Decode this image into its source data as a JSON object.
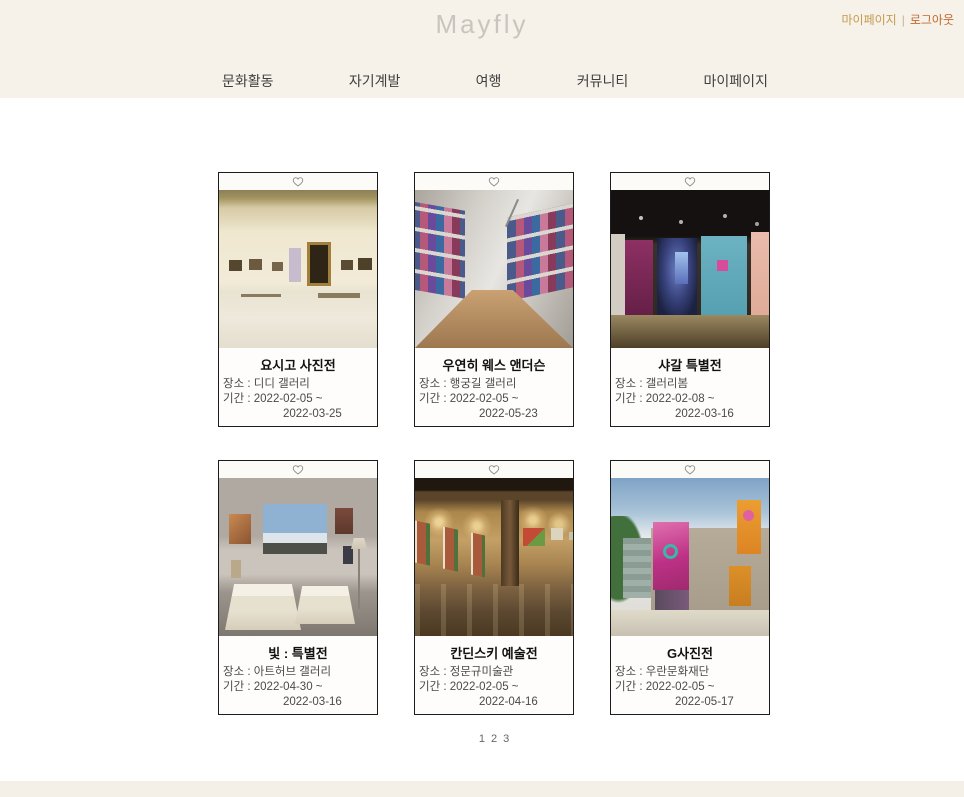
{
  "header": {
    "logo": "Mayfly",
    "links": {
      "mypage": "마이페이지",
      "separator": "|",
      "logout": "로그아웃"
    }
  },
  "nav": {
    "items": [
      {
        "label": "문화활동"
      },
      {
        "label": "자기계발"
      },
      {
        "label": "여행"
      },
      {
        "label": "커뮤니티"
      },
      {
        "label": "마이페이지"
      }
    ]
  },
  "exhibitions": [
    {
      "title": "요시고 사진전",
      "venue_label": "장소 :",
      "venue": "디디 갤러리",
      "period_label": "기간 :",
      "period_start": "2022-02-05 ~",
      "period_end": "2022-03-25",
      "image": "cream-gallery-framed-art"
    },
    {
      "title": "우연히 웨스 앤더슨",
      "venue_label": "장소 :",
      "venue": "행궁길 갤러리",
      "period_label": "기간 :",
      "period_start": "2022-02-05 ~",
      "period_end": "2022-05-23",
      "image": "white-gallery-colorful-photo-grid"
    },
    {
      "title": "샤갈 특별전",
      "venue_label": "장소 :",
      "venue": "갤러리봄",
      "period_label": "기간 :",
      "period_start": "2022-02-08 ~",
      "period_end": "2022-03-16",
      "image": "dark-gallery-magenta-blue-walls"
    },
    {
      "title": "빛 : 특별전",
      "venue_label": "장소 :",
      "venue": "아트허브 갤러리",
      "period_label": "기간 :",
      "period_start": "2022-04-30 ~",
      "period_end": "2022-03-16",
      "image": "exhibit-room-paris-photos-draped-tables"
    },
    {
      "title": "칸딘스키 예술전",
      "venue_label": "장소 :",
      "venue": "정문규미술관",
      "period_label": "기간 :",
      "period_start": "2022-02-05 ~",
      "period_end": "2022-04-16",
      "image": "warm-gallery-spotlit-paintings"
    },
    {
      "title": "G사진전",
      "venue_label": "장소 :",
      "venue": "우란문화재단",
      "period_label": "기간 :",
      "period_start": "2022-02-05 ~",
      "period_end": "2022-05-17",
      "image": "museum-exterior-pink-orange-banners"
    }
  ],
  "pagination": {
    "pages": [
      "1",
      "2",
      "3"
    ]
  },
  "icons": {
    "favorite": "heart-outline"
  },
  "colors": {
    "header_bg": "#f6f2ea",
    "mypage_link": "#c49a4d",
    "logout_link": "#c06a2e",
    "logo_gray": "#c8c5bf",
    "nav_text": "#3f3f3f",
    "card_border": "#1c1c1c"
  }
}
